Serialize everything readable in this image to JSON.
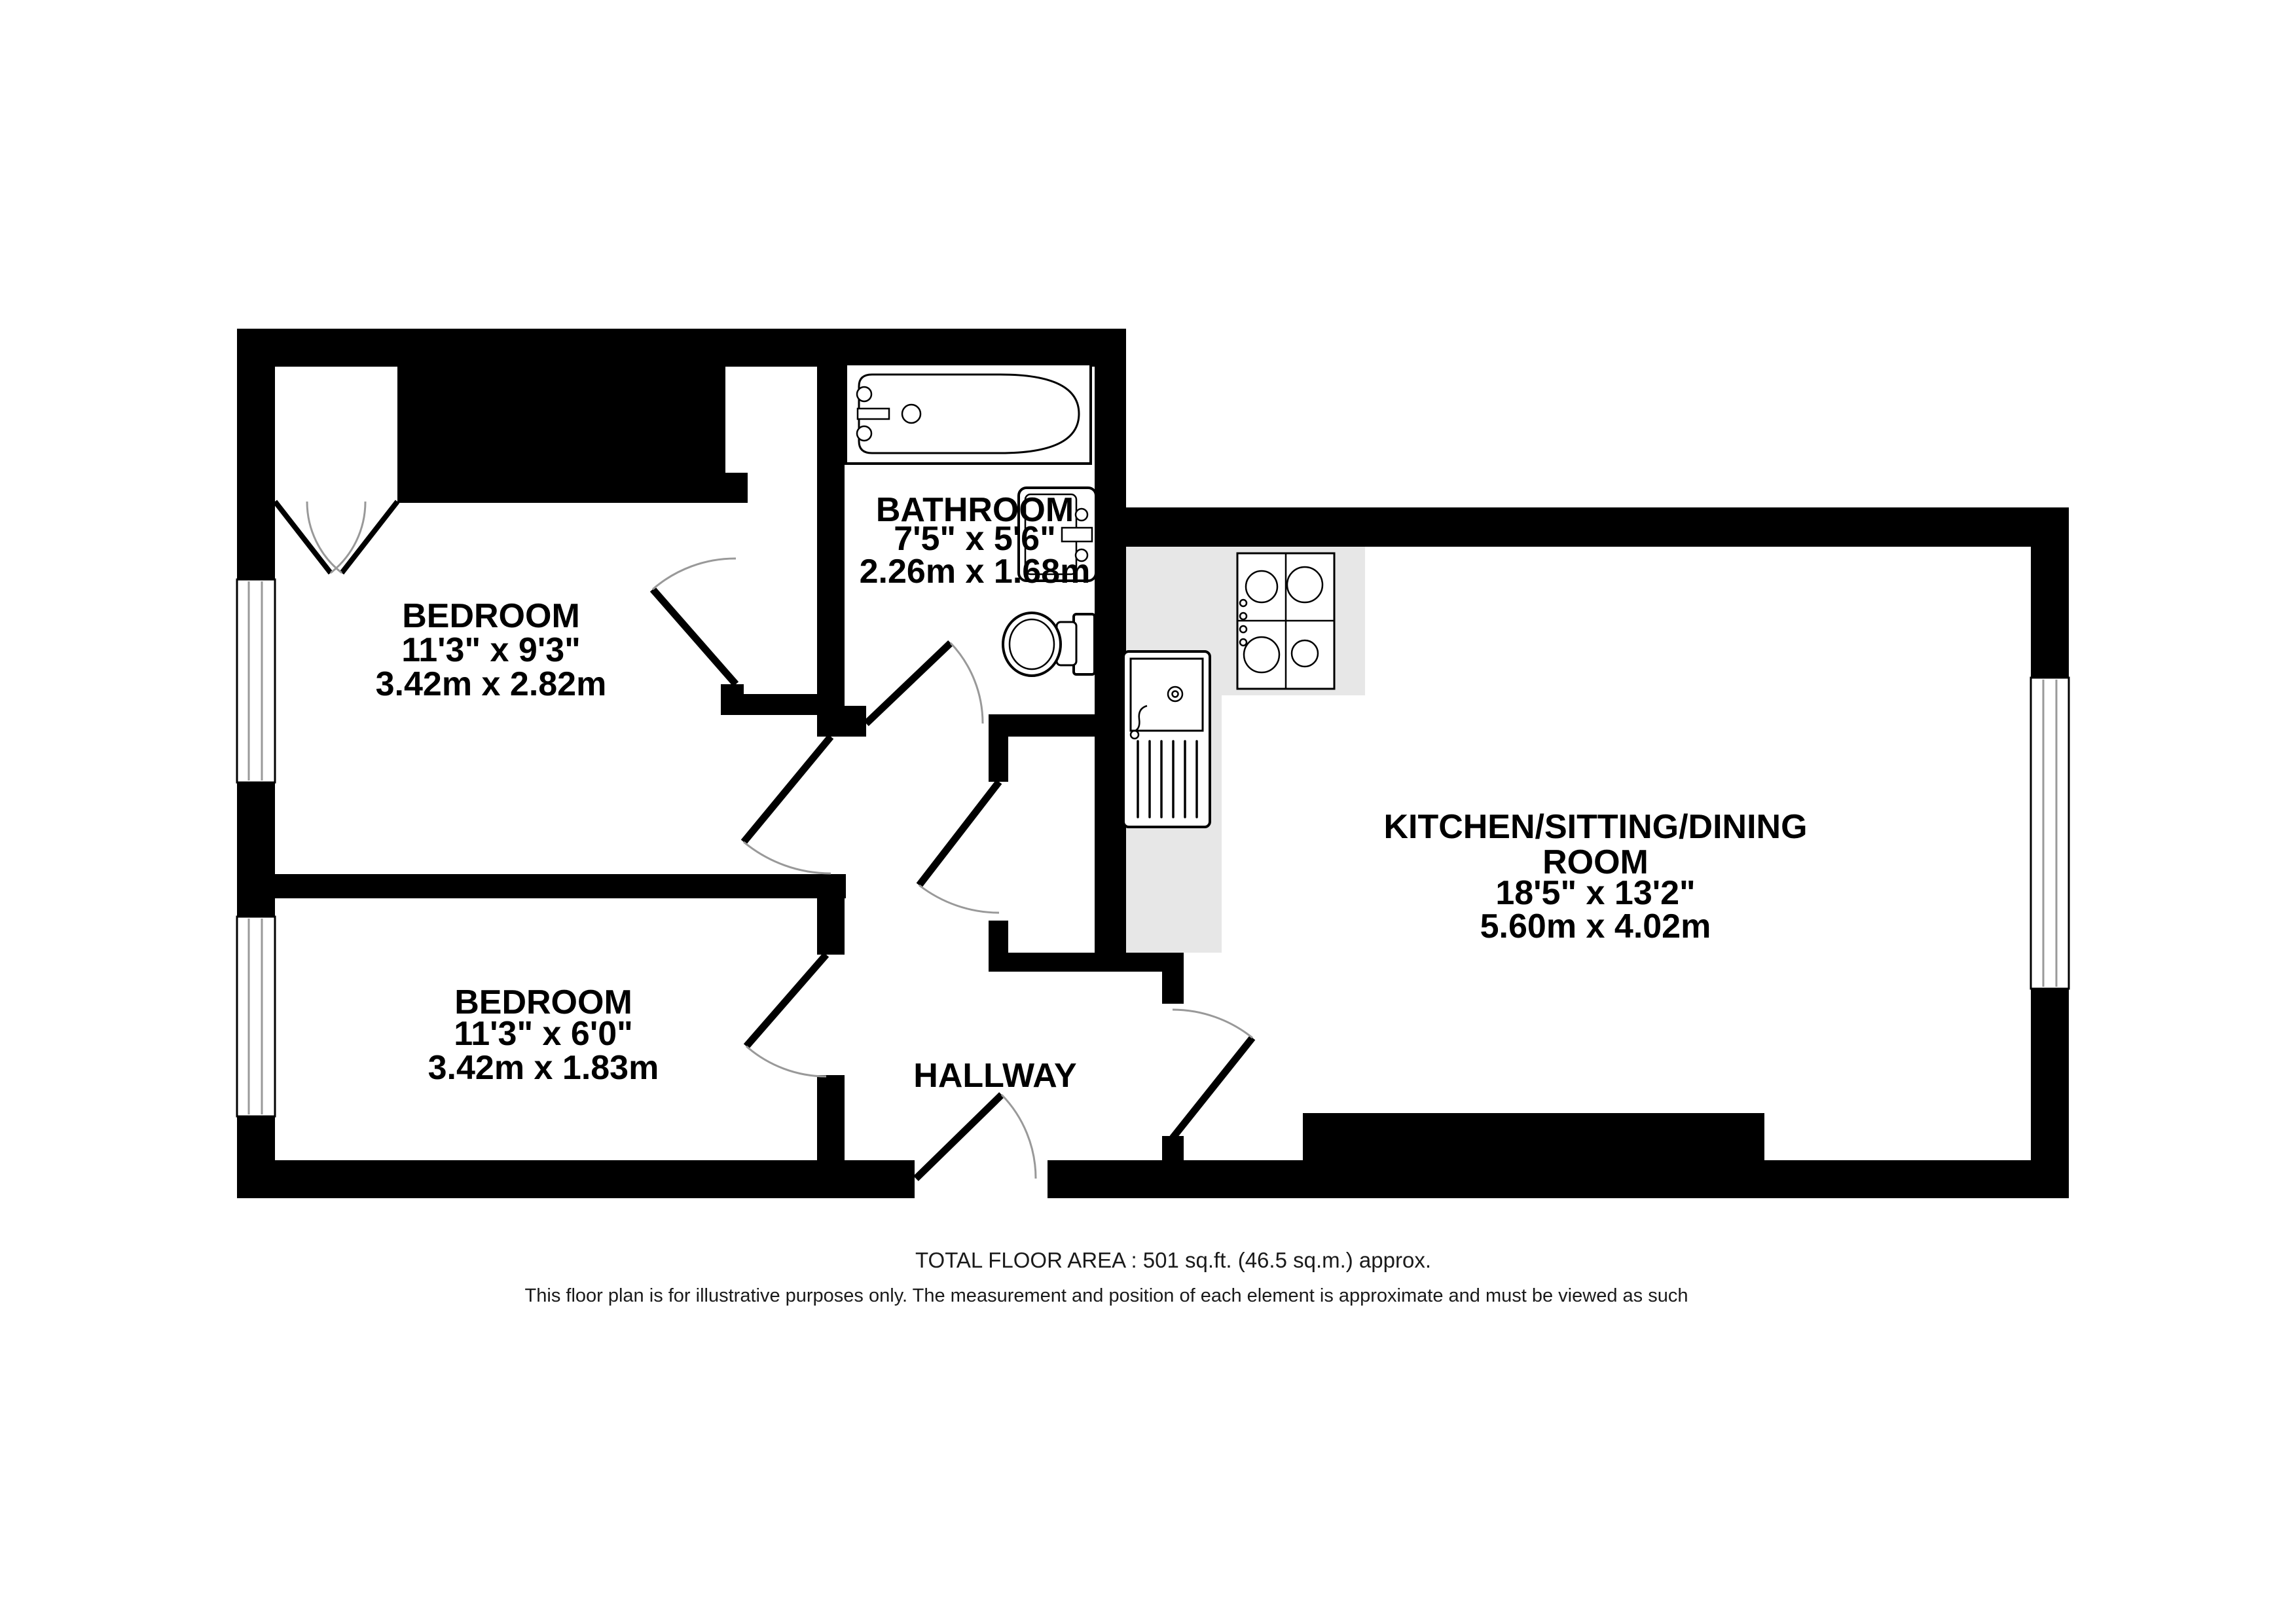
{
  "rooms": {
    "bedroom1": {
      "name": "BEDROOM",
      "imperial": "11'3\"  x 9'3\"",
      "metric": "3.42m  x 2.82m"
    },
    "bedroom2": {
      "name": "BEDROOM",
      "imperial": "11'3\"  x 6'0\"",
      "metric": "3.42m  x 1.83m"
    },
    "bathroom": {
      "name": "BATHROOM",
      "imperial": "7'5\"  x 5'6\"",
      "metric": "2.26m  x 1.68m"
    },
    "kitchen": {
      "name_line1": "KITCHEN/SITTING/DINING",
      "name_line2": "ROOM",
      "imperial": "18'5\"  x 13'2\"",
      "metric": "5.60m  x 4.02m"
    },
    "hallway": {
      "name": "HALLWAY"
    }
  },
  "footer": {
    "total_area": "TOTAL FLOOR AREA : 501 sq.ft. (46.5 sq.m.) approx.",
    "disclaimer": "This floor plan is for illustrative purposes only. The measurement and position of each element is approximate and must be viewed as such"
  },
  "fixtures": {
    "bathtub": "bathtub",
    "toilet": "toilet",
    "basin": "wash-basin",
    "hob": "four-ring-hob",
    "sink": "sink-with-drainer",
    "counter": "kitchen-worktop"
  },
  "colors": {
    "walls": "#000000",
    "counter": "#e7e7e7",
    "door_arc": "#999999",
    "window_line": "#9a9a9a",
    "text": "#000000",
    "footer_text": "#1a1a1a",
    "background": "#ffffff"
  }
}
